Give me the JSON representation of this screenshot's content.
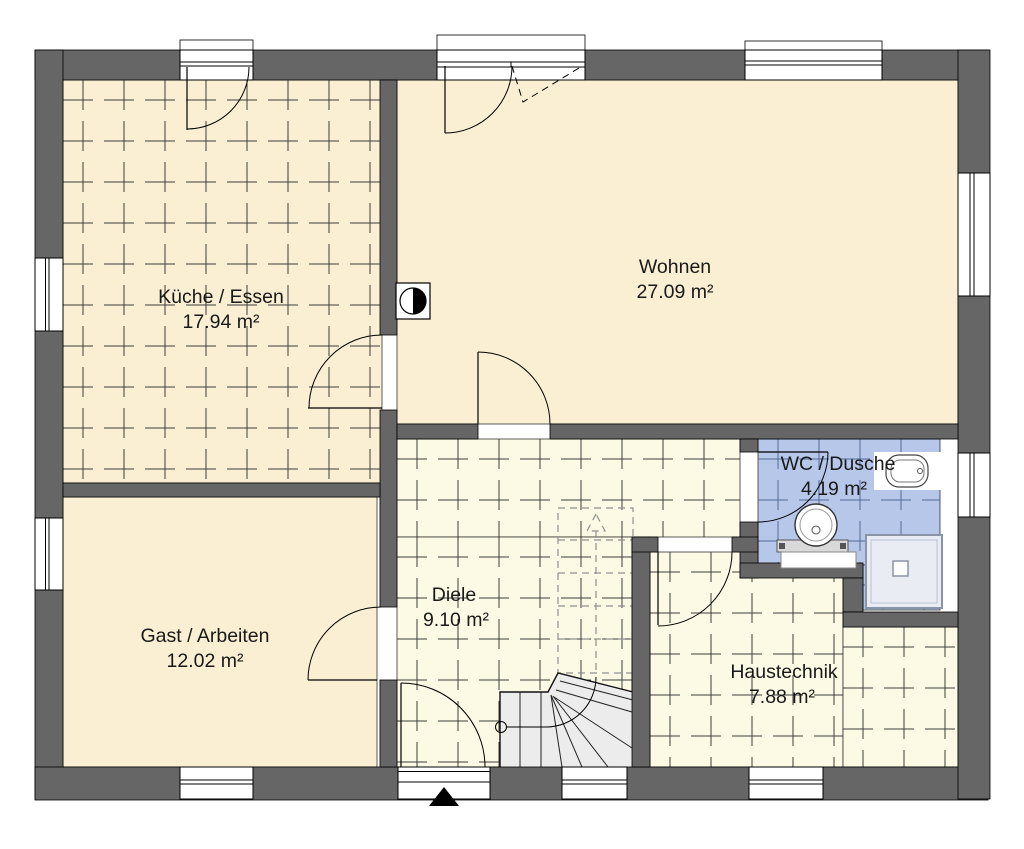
{
  "rooms": {
    "kueche": {
      "label": "Küche / Essen",
      "area": "17.94 m²"
    },
    "wohnen": {
      "label": "Wohnen",
      "area": "27.09 m²"
    },
    "gast": {
      "label": "Gast / Arbeiten",
      "area": "12.02 m²"
    },
    "diele": {
      "label": "Diele",
      "area": "9.10 m²"
    },
    "wc": {
      "label": "WC / Dusche",
      "area": "4.19 m²"
    },
    "haustechnik": {
      "label": "Haustechnik",
      "area": "7.88 m²"
    }
  },
  "colors": {
    "wall": "#666666",
    "floor_beige": "#faefd2",
    "floor_pale": "#fcfae4",
    "floor_blue": "#b7c7e9",
    "grid_dark": "#2a2a2a",
    "grid_blue": "#46618f",
    "stair_fill": "#ececec",
    "shower_fill": "#e9edf3"
  },
  "fixtures": [
    "chimney",
    "toilet",
    "washbasin",
    "shower-tray",
    "entrance-arrow",
    "stair-up-arrow"
  ],
  "floor": {
    "regions": [
      {
        "name": "wohnen-floor",
        "x": 397,
        "y": 80,
        "w": 561,
        "h": 344,
        "fill": "#faefd2",
        "grid": false
      },
      {
        "name": "gast-floor",
        "x": 63,
        "y": 497,
        "w": 314,
        "h": 270,
        "fill": "#faefd2",
        "grid": false
      },
      {
        "name": "kueche-floor",
        "x": 63,
        "y": 80,
        "w": 319,
        "h": 403,
        "fill": "#faefd2",
        "grid": true,
        "line": "#2a2a2a",
        "size": 41
      },
      {
        "name": "diele-floor-upper",
        "x": 397,
        "y": 439,
        "w": 343,
        "h": 98,
        "fill": "#fcfae4",
        "grid": true,
        "line": "#2a2a2a",
        "size": 41
      },
      {
        "name": "diele-floor-lower",
        "x": 397,
        "y": 537,
        "w": 235,
        "h": 230,
        "fill": "#fcfae4",
        "grid": true,
        "line": "#2a2a2a",
        "size": 41
      },
      {
        "name": "haustechnik-floor-left",
        "x": 650,
        "y": 552,
        "w": 193,
        "h": 215,
        "fill": "#fcfae4",
        "grid": true,
        "line": "#2a2a2a",
        "size": 41
      },
      {
        "name": "haustechnik-floor-right",
        "x": 843,
        "y": 627,
        "w": 115,
        "h": 140,
        "fill": "#fcfae4",
        "grid": true,
        "line": "#2a2a2a",
        "size": 41
      },
      {
        "name": "wc-floor-main",
        "x": 758,
        "y": 439,
        "w": 182,
        "h": 126,
        "fill": "#b7c7e9",
        "grid": true,
        "line": "#46618f",
        "size": 41
      },
      {
        "name": "wc-floor-niche",
        "x": 863,
        "y": 565,
        "w": 77,
        "h": 45,
        "fill": "#b7c7e9",
        "grid": true,
        "line": "#46618f",
        "size": 41
      }
    ]
  }
}
